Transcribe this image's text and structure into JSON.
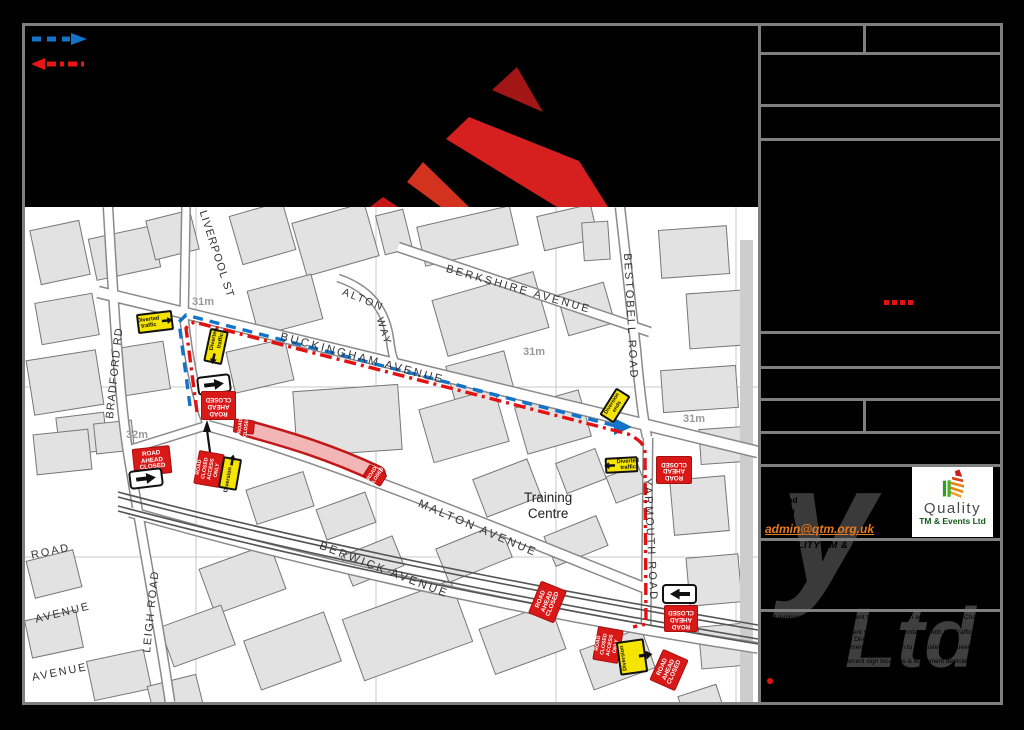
{
  "window": {
    "background": "#000000"
  },
  "legend": {
    "route_out_color": "#1273c8",
    "route_back_color": "#e81616"
  },
  "logo_shapes": {
    "colors": [
      "#a31616",
      "#d62020",
      "#d2321e",
      "#c41414"
    ]
  },
  "map": {
    "closure_color": "#c21717",
    "street_labels": [
      {
        "text": "BRADFORD RD",
        "x": 104,
        "y": 418,
        "rot": -84,
        "size": 11,
        "ls": 1
      },
      {
        "text": "LIVERPOOL ST",
        "x": 208,
        "y": 209,
        "rot": 72,
        "size": 11,
        "ls": 1
      },
      {
        "text": "ALTON",
        "x": 345,
        "y": 286,
        "rot": 22,
        "size": 10.5,
        "ls": 2
      },
      {
        "text": "WAY",
        "x": 385,
        "y": 316,
        "rot": 72,
        "size": 10.5,
        "ls": 2
      },
      {
        "text": "BERKSHIRE AVENUE",
        "x": 448,
        "y": 263,
        "rot": 16,
        "size": 11,
        "ls": 2.5
      },
      {
        "text": "BESTOBELL ROAD",
        "x": 633,
        "y": 253,
        "rot": 87,
        "size": 11,
        "ls": 2
      },
      {
        "text": "BUCKINGHAM AVENUE",
        "x": 282,
        "y": 331,
        "rot": 15,
        "size": 11.5,
        "ls": 2.5
      },
      {
        "text": "YARMOUTH ROAD",
        "x": 653,
        "y": 478,
        "rot": 87,
        "size": 11,
        "ls": 2
      },
      {
        "text": "MALTON AVENUE",
        "x": 421,
        "y": 498,
        "rot": 23,
        "size": 11.5,
        "ls": 2.5
      },
      {
        "text": "BERWICK AVENUE",
        "x": 322,
        "y": 540,
        "rot": 21,
        "size": 11.5,
        "ls": 2.5
      },
      {
        "text": "LEIGH ROAD",
        "x": 141,
        "y": 652,
        "rot": -84,
        "size": 11,
        "ls": 1.5
      },
      {
        "text": "ROAD",
        "x": 30,
        "y": 550,
        "rot": -12,
        "size": 11,
        "ls": 2
      },
      {
        "text": "AVENUE",
        "x": 34,
        "y": 614,
        "rot": -14,
        "size": 11,
        "ls": 2
      },
      {
        "text": "AVENUE",
        "x": 31,
        "y": 672,
        "rot": -11,
        "size": 11,
        "ls": 2
      }
    ],
    "area_labels": [
      {
        "text": "Training\nCentre",
        "x": 524,
        "y": 490,
        "size": 13.5
      }
    ],
    "elevation_labels": [
      {
        "text": "31m",
        "x": 192,
        "y": 296
      },
      {
        "text": "31m",
        "x": 523,
        "y": 346
      },
      {
        "text": "31m",
        "x": 683,
        "y": 413
      },
      {
        "text": "32m",
        "x": 126,
        "y": 429
      }
    ],
    "signs": [
      {
        "type": "white-arrow",
        "dir": "right",
        "x": 197,
        "y": 375,
        "w": 34,
        "h": 19,
        "rot": -7
      },
      {
        "type": "road-ahead-closed",
        "text": "ROAD\nAHEAD\nCLOSED",
        "x": 201,
        "y": 391,
        "w": 35,
        "h": 29,
        "rot": 180
      },
      {
        "type": "diverted-traffic",
        "text": "Diverted\ntraffic",
        "arrow": "right",
        "arrow_pos": "after",
        "x": 137,
        "y": 312,
        "w": 36,
        "h": 20,
        "rot": -7
      },
      {
        "type": "diverted-traffic",
        "text": "Diverted\ntraffic",
        "arrow": "left",
        "arrow_pos": "before",
        "x": 199,
        "y": 337,
        "w": 34,
        "h": 19,
        "rot": -78
      },
      {
        "type": "road-closed",
        "text": "ROAD\nCLOSED",
        "x": 237,
        "y": 416,
        "w": 14,
        "h": 21,
        "rot": -84
      },
      {
        "type": "road-closed-access-only",
        "text": "ROAD\nCLOSED\nACCESS\nONLY",
        "x": 192,
        "y": 456,
        "w": 34,
        "h": 26,
        "rot": -80
      },
      {
        "type": "diversion",
        "text": "Diversion",
        "arrow": "right",
        "arrow_pos": "after",
        "x": 214,
        "y": 464,
        "w": 32,
        "h": 19,
        "rot": -80
      },
      {
        "type": "road-ahead-closed",
        "text": "ROAD\nAHEAD\nCLOSED",
        "x": 133,
        "y": 447,
        "w": 38,
        "h": 28,
        "rot": -6
      },
      {
        "type": "white-arrow",
        "dir": "right",
        "x": 129,
        "y": 469,
        "w": 34,
        "h": 19,
        "rot": -7
      },
      {
        "type": "road-closed",
        "text": "ROAD\nCLOSED",
        "x": 368,
        "y": 465,
        "w": 14,
        "h": 21,
        "rot": -58
      },
      {
        "type": "diversion-ends",
        "text": "Diversion\nends",
        "x": 599,
        "y": 397,
        "w": 32,
        "h": 17,
        "rot": -58
      },
      {
        "type": "diverted-traffic",
        "text": "Diverted\ntraffic",
        "arrow": "left",
        "arrow_pos": "before",
        "x": 605,
        "y": 457,
        "w": 33,
        "h": 16,
        "rot": -3
      },
      {
        "type": "road-ahead-closed",
        "text": "ROAD\nAHEAD\nCLOSED",
        "x": 656,
        "y": 456,
        "w": 36,
        "h": 28,
        "rot": 180
      },
      {
        "type": "road-ahead-closed",
        "text": "ROAD\nAHEAD\nCLOSED",
        "x": 530,
        "y": 588,
        "w": 35,
        "h": 28,
        "rot": -68
      },
      {
        "type": "white-arrow",
        "dir": "left",
        "x": 662,
        "y": 584,
        "w": 35,
        "h": 20,
        "rot": 0
      },
      {
        "type": "road-ahead-closed",
        "text": "ROAD\nAHEAD\nCLOSED",
        "x": 664,
        "y": 605,
        "w": 34,
        "h": 27,
        "rot": 180
      },
      {
        "type": "road-closed-access-only",
        "text": "ROAD\nCLOSED\nACCESS\nONLY",
        "x": 591,
        "y": 632,
        "w": 34,
        "h": 26,
        "rot": -80
      },
      {
        "type": "diversion-vertical",
        "text": "Diversion",
        "x": 618,
        "y": 640,
        "w": 28,
        "h": 34,
        "rot": -8
      },
      {
        "type": "road-ahead-closed",
        "text": "ROAD\nAHEAD\nCLOSED",
        "x": 652,
        "y": 656,
        "w": 34,
        "h": 28,
        "rot": -66
      }
    ]
  },
  "titleblock": {
    "address_lines": [
      "20-22 Wenlock Road",
      "London",
      "England",
      "N1 7GU"
    ],
    "email": "admin@qtm.org.uk",
    "company_line": "QUALITY TM & EVENTS",
    "watermark": {
      "y": "y",
      "ltd": "Ltd"
    },
    "logo": {
      "name": "Quality",
      "subtitle": "TM & Events Ltd"
    },
    "inline_dash_color": "#e31212",
    "notes": [
      "All temporary traffic management to be installed in accordance with Chapter 8",
      "of the Traffic Signs Manual",
      "All temporary signing equipment shall be in accordance with the Traffic",
      "Signs Regulations & General Directions 2016",
      "All temporary traffic management shall conform to the Safety at Street Works",
      "Code of Practice 2013",
      "All temporary traffic management sign locations & equipment depicted is",
      "indicative and may be adjusted to suit site conditions"
    ]
  }
}
